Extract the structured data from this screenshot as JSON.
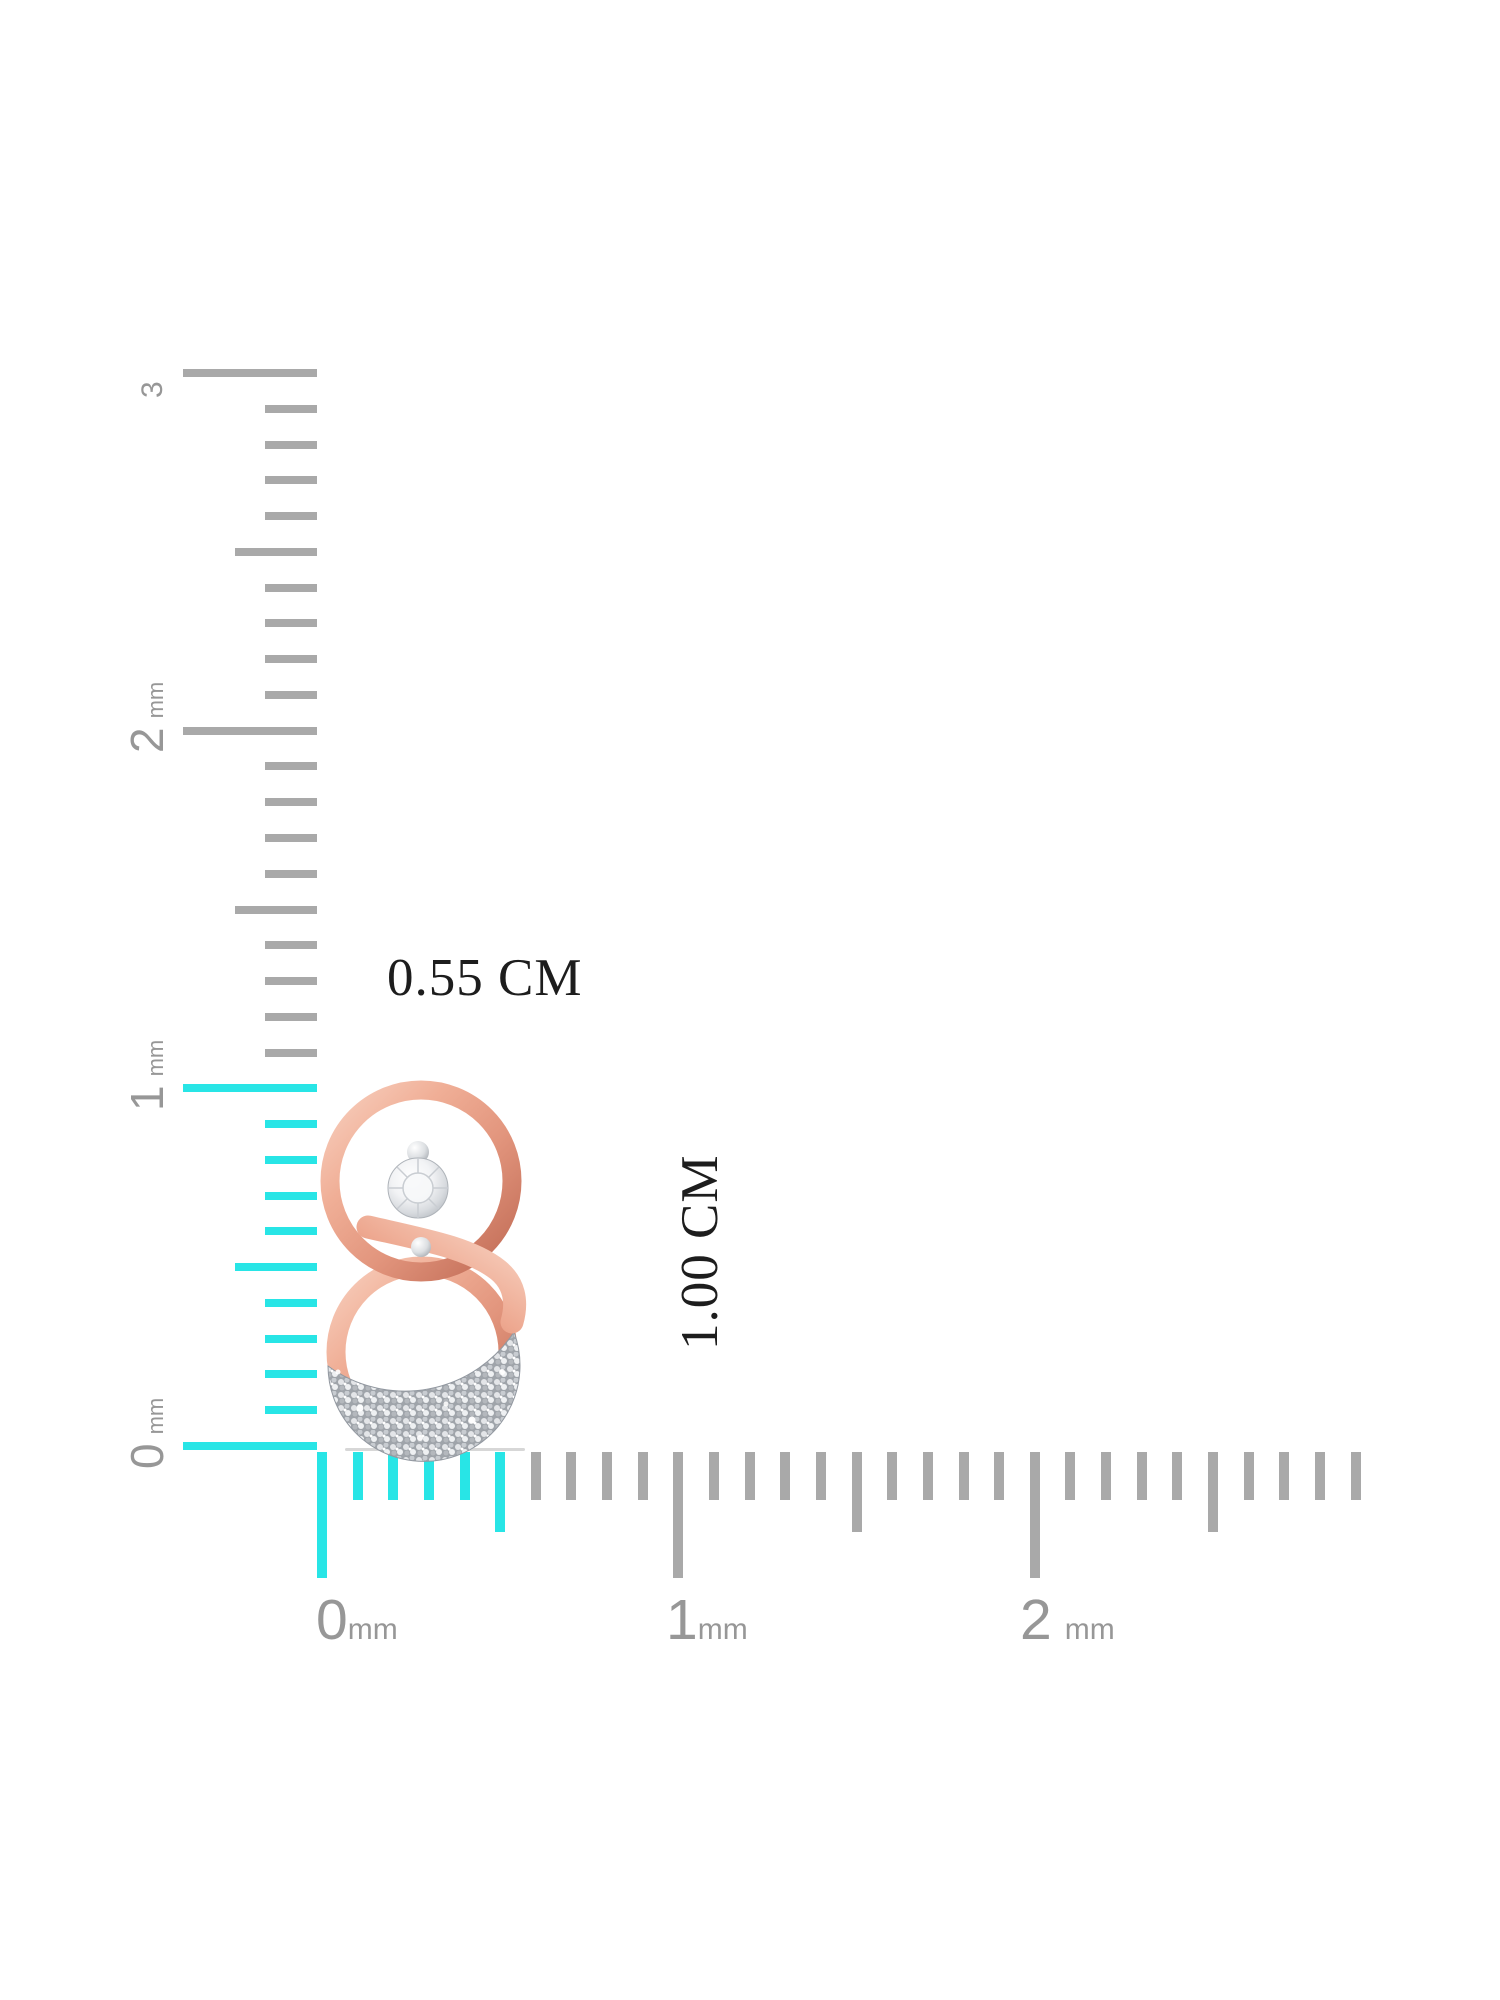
{
  "measurements": {
    "width": "0.55 CM",
    "height": "1.00 CM"
  },
  "colors": {
    "background": "#ffffff",
    "tick_gray": "#a9a9a9",
    "tick_cyan": "#28e5e6",
    "label_gray": "#979797",
    "measure_text": "#1d1d1d",
    "rose_gold": "#e89e88",
    "rose_gold_dark": "#c06a54",
    "rose_gold_light": "#f8d0bf",
    "pave_silver": "#a9adb3",
    "diamond_white": "#ffffff"
  },
  "vertical_ruler": {
    "unit": "mm",
    "orientation": "vertical",
    "labels": [
      {
        "value": "3",
        "unit": ""
      },
      {
        "value": "2",
        "unit": "mm"
      },
      {
        "value": "1",
        "unit": "mm"
      },
      {
        "value": "0",
        "unit": "mm"
      }
    ],
    "count": 31,
    "minor_spacing": 35.767,
    "origin_y": 373,
    "edge_x": 317,
    "cyan_from_index": 20,
    "major_len": 134,
    "medium_len": 82,
    "minor_len": 52,
    "thickness": 8
  },
  "horizontal_ruler": {
    "unit": "mm",
    "orientation": "horizontal",
    "labels": [
      {
        "value": "0",
        "unit": "mm"
      },
      {
        "value": "1",
        "unit": "mm"
      },
      {
        "value": "2",
        "unit": "mm"
      }
    ],
    "count": 30,
    "minor_spacing": 35.64,
    "origin_x": 322,
    "edge_y": 1452,
    "cyan_to_index": 5,
    "major_len": 126,
    "medium_len": 80,
    "minor_len": 48,
    "thickness": 10
  },
  "jewelry": {
    "description": "rose gold interlocking double-circle earring with solitaire diamond and pave diamond arc"
  }
}
